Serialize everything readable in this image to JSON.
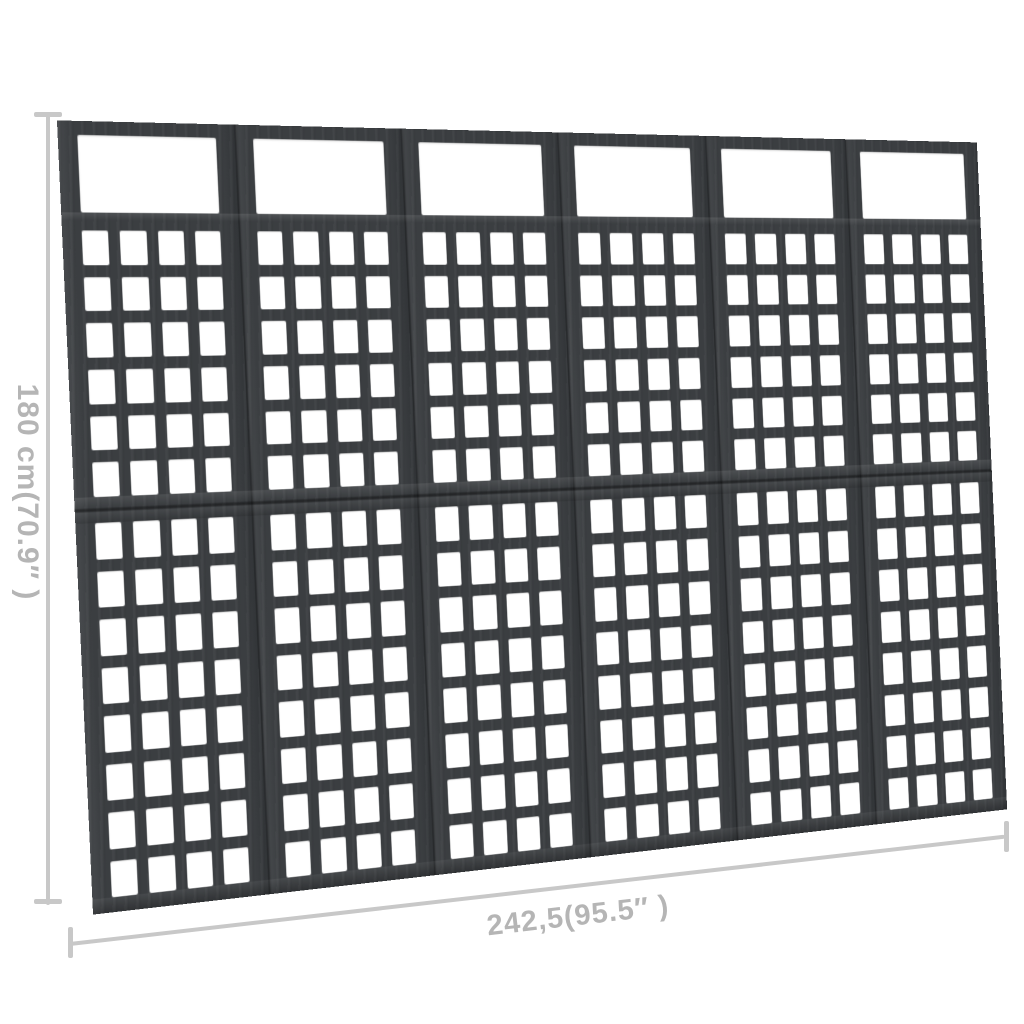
{
  "image": {
    "background_color": "#ffffff"
  },
  "divider": {
    "panel_count": 6,
    "wood_color": "#3b3e41",
    "hole_color": "#ffffff",
    "top_window_per_panel": 1,
    "upper_grid": {
      "rows": 6,
      "cols": 4
    },
    "lower_grid": {
      "rows": 8,
      "cols": 4
    }
  },
  "height_dimension": {
    "label": "180 cm(70.9″ )"
  },
  "width_dimension": {
    "label": "242,5(95.5″ )"
  },
  "annotation": {
    "line_color": "#c8c8c8",
    "text_color": "#b5b5b5"
  }
}
